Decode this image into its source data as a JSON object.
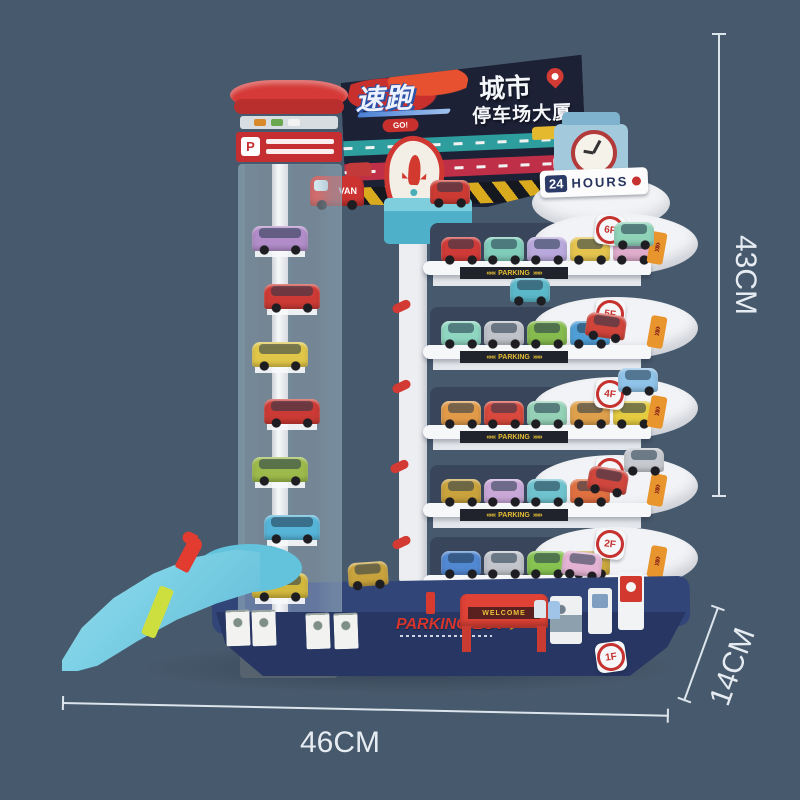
{
  "scene": {
    "bg": "#47596c"
  },
  "dimensions": {
    "height": "43CM",
    "depth": "14CM",
    "width": "46CM"
  },
  "billboard": {
    "logo_main": "速跑",
    "logo_sub": "GO!",
    "title_line1": "城市",
    "title_line2": "停车场大厦"
  },
  "hours_sign": {
    "num": "24",
    "text": "HOURS"
  },
  "tower": {
    "p_label": "P"
  },
  "banner": {
    "left": "«««",
    "label": "PARKING",
    "right": "»»»"
  },
  "chevron_glyph": "»»",
  "van_label": "VAN",
  "base": {
    "parking_lot": "PARKING LOT",
    "arrow": "➤",
    "welcome": "WELCOME",
    "badge": "1F"
  },
  "levels": [
    {
      "badge": "6F",
      "cars": [
        "#cf3a37",
        "#7fccba",
        "#b9a8dc",
        "#e5c44e",
        "#dfaccb"
      ]
    },
    {
      "badge": "5F",
      "cars": [
        "#8fd6c0",
        "#bfc2c8",
        "#86bb4e",
        "#4f9fd6"
      ]
    },
    {
      "badge": "4F",
      "cars": [
        "#e09a48",
        "#d8483c",
        "#94d1b6",
        "#dfa04b",
        "#e5cb40"
      ]
    },
    {
      "badge": "3F",
      "cars": [
        "#c9a23c",
        "#c9a8d8",
        "#6fc3cf",
        "#df7040"
      ]
    },
    {
      "badge": "2F",
      "cars": [
        "#5188d2",
        "#c2c5cb",
        "#86c351",
        "#c9a73e"
      ]
    }
  ],
  "elevator_cars": [
    "#b18cc9",
    "#cd3a35",
    "#e0c648",
    "#cb3a34",
    "#9cba4b",
    "#56b4d8",
    "#d3b83e"
  ],
  "extras": {
    "x1": [
      "#8fd3b9"
    ],
    "x2": [
      "#5bb8c9"
    ],
    "x3": [
      "#d0443a"
    ],
    "x4": [
      "#8fc3e8"
    ],
    "x5": [
      "#cf463c"
    ],
    "x6": [
      "#c6c9cf"
    ],
    "x7": [
      "#e4b3d3"
    ],
    "x9": [
      "#cc3b33"
    ],
    "x10": [
      "#c8a23c"
    ]
  }
}
